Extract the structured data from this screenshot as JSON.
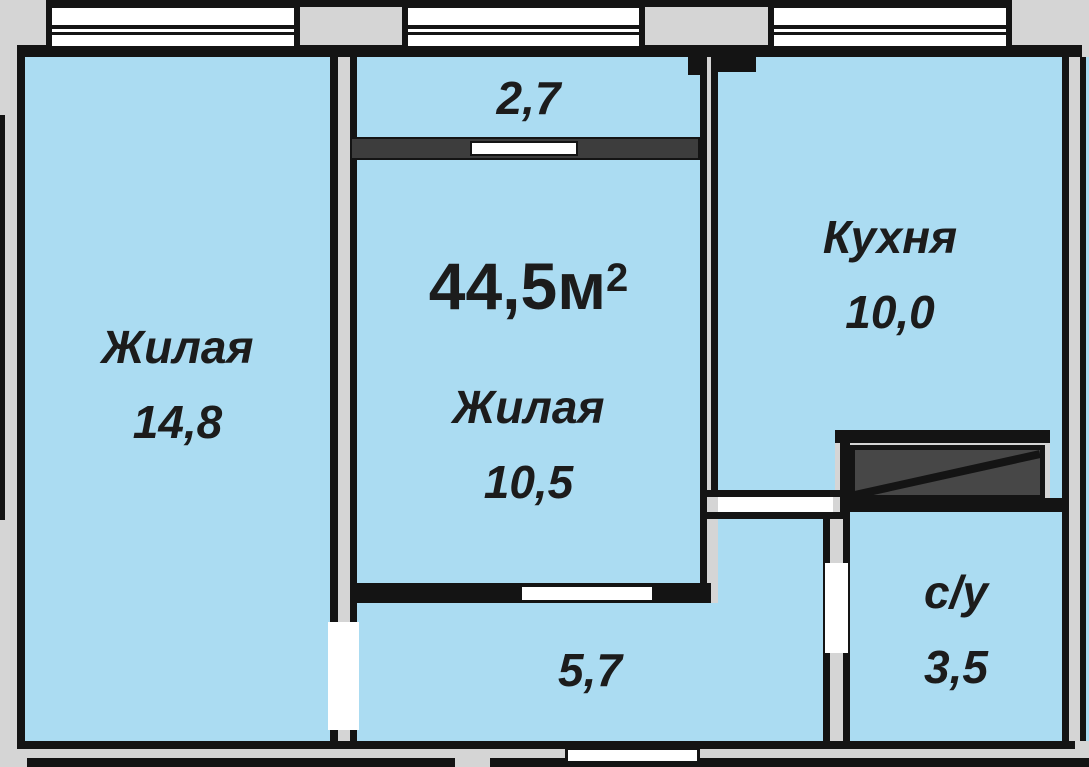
{
  "title": "Apartment floor plan 44,5 m2",
  "colors": {
    "background": "#d5d5d5",
    "room_fill": "#abdcf2",
    "wall": "#141414",
    "vent_fill": "#474747",
    "sill_fill": "#3d3d3d",
    "opening": "#ffffff",
    "text": "#1c1c1c"
  },
  "total_area": {
    "value": "44,5м",
    "sup": "2"
  },
  "rooms": [
    {
      "key": "living-1",
      "name": "Жилая",
      "area": "14,8"
    },
    {
      "key": "balcony",
      "name": "",
      "area": "2,7"
    },
    {
      "key": "living-2",
      "name": "Жилая",
      "area": "10,5"
    },
    {
      "key": "kitchen",
      "name": "Кухня",
      "area": "10,0"
    },
    {
      "key": "bathroom",
      "name": "с/у",
      "area": "3,5"
    },
    {
      "key": "hallway",
      "name": "",
      "area": "5,7"
    }
  ]
}
